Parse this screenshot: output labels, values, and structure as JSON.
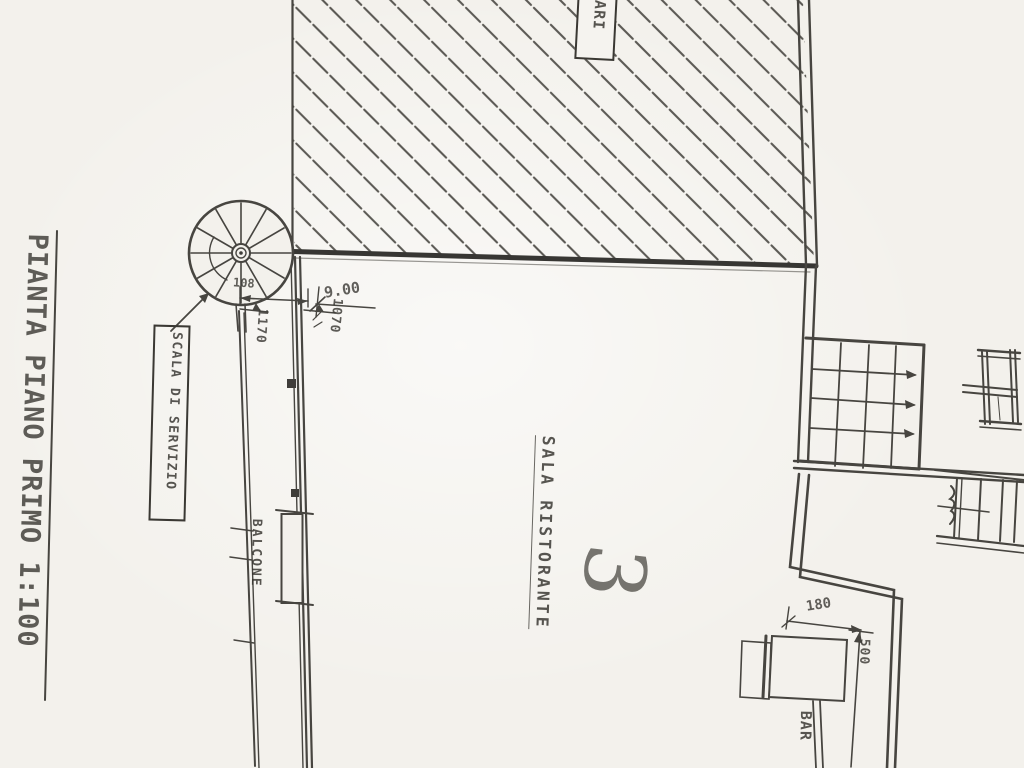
{
  "colors": {
    "paper": "#f3f1ec",
    "ink": "#34322d"
  },
  "title": {
    "text": "PIANTA PIANO PRIMO 1:100"
  },
  "labels": {
    "building_partial": "ARI",
    "service_stair": "SCALA DI SERVIZIO",
    "balcony": "BALCONE",
    "dining_room": "SALA RISTORANTE",
    "room_number": "3",
    "bar": "BAR"
  },
  "dimensions": {
    "stair_landing": "108",
    "room_width": "9.00",
    "balcony_length": "1170",
    "room_depth": "1070",
    "bar_nook_width": "180",
    "bar_nook_depth": "500"
  }
}
